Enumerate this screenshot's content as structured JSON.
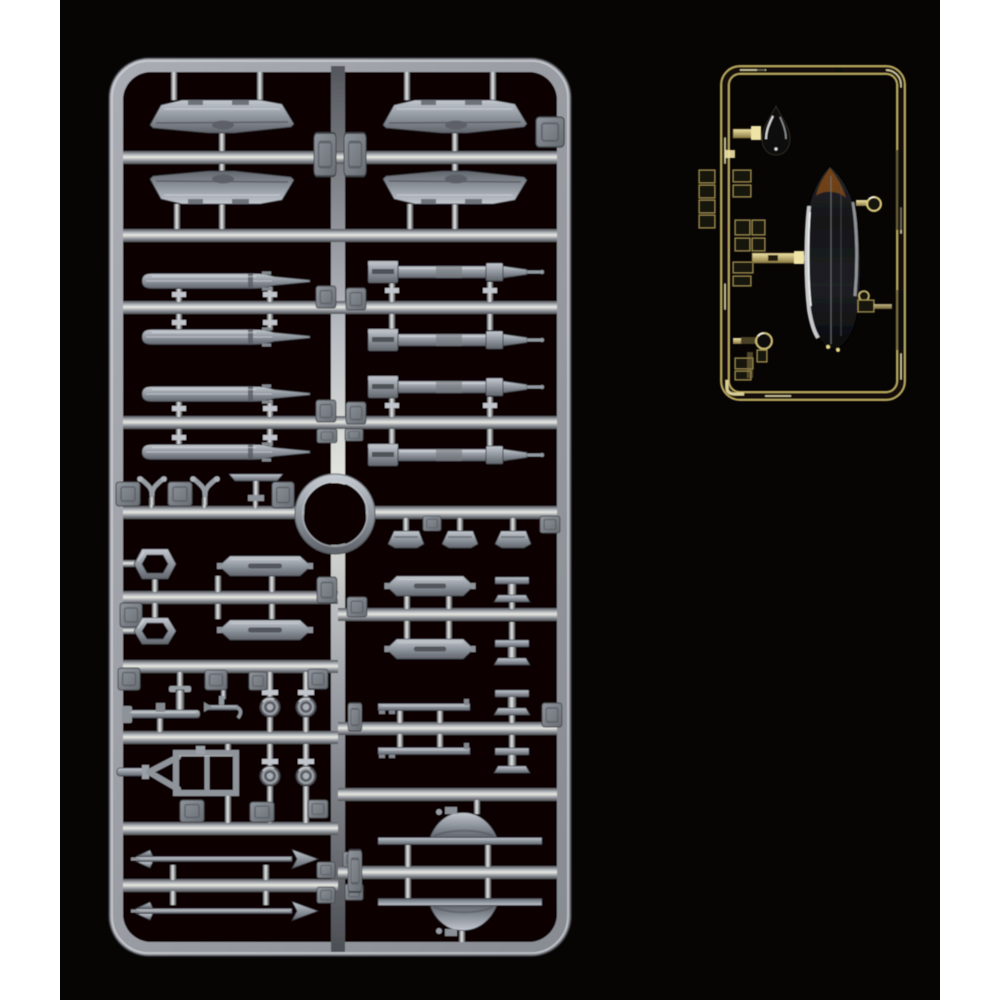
{
  "scene": {
    "description": "Product photograph of injection-molded model kit sprues on a black background: one large light-gray styrene sprue holding weapons, drop tanks, pylons, wheels and landing-gear parts, and one small gold-tinted clear sprue holding a bubble canopy, a teardrop light cover and small lenses.",
    "background_color": "#070404",
    "matte_color": "#ffffff"
  },
  "palette": {
    "styrene_base": "#9ba0a7",
    "styrene_highlight": "#e7e9ec",
    "styrene_shadow": "#4c4f54",
    "clear_gold": "#d8c87e",
    "clear_dark": "#15110a",
    "canopy_tint": "#1e2024",
    "canopy_apex_tint": "#8a4c14"
  },
  "sprues": [
    {
      "id": "sprue-a",
      "material": "light gray styrene",
      "plastic_color": "#9ba0a7",
      "ejector_tab_count": 31,
      "parts": [
        {
          "name": "upper-wing-half",
          "count": 2
        },
        {
          "name": "lower-wing-half",
          "count": 2
        },
        {
          "name": "drop-tank-half",
          "count": 4
        },
        {
          "name": "guided-missile-body",
          "count": 4
        },
        {
          "name": "air-to-air-missile",
          "count": 2
        },
        {
          "name": "wing-pylon",
          "count": 4
        },
        {
          "name": "launch-rail",
          "count": 2
        },
        {
          "name": "rail-adapter-shoe",
          "count": 3
        },
        {
          "name": "rail-bracket",
          "count": 4
        },
        {
          "name": "wheel",
          "count": 4
        },
        {
          "name": "landing-gear-strut",
          "count": 1
        },
        {
          "name": "nose-gear-fork",
          "count": 1
        },
        {
          "name": "antenna-fork",
          "count": 2
        },
        {
          "name": "pitot-tee",
          "count": 1
        },
        {
          "name": "ring-collar",
          "count": 1
        },
        {
          "name": "hex-ring-grip",
          "count": 2
        },
        {
          "name": "fuselage-spine-half",
          "count": 2
        },
        {
          "name": "small-anchor-fitting",
          "count": 1
        }
      ]
    },
    {
      "id": "sprue-b",
      "material": "clear styrene with gold tint",
      "plastic_color": "#d8c87e",
      "parts": [
        {
          "name": "bubble-canopy",
          "count": 1
        },
        {
          "name": "teardrop-light-cover",
          "count": 1
        },
        {
          "name": "round-lens",
          "count": 2
        },
        {
          "name": "side-lamp-bracket",
          "count": 1
        },
        {
          "name": "clear-instrument-box",
          "count": 10
        }
      ]
    }
  ]
}
